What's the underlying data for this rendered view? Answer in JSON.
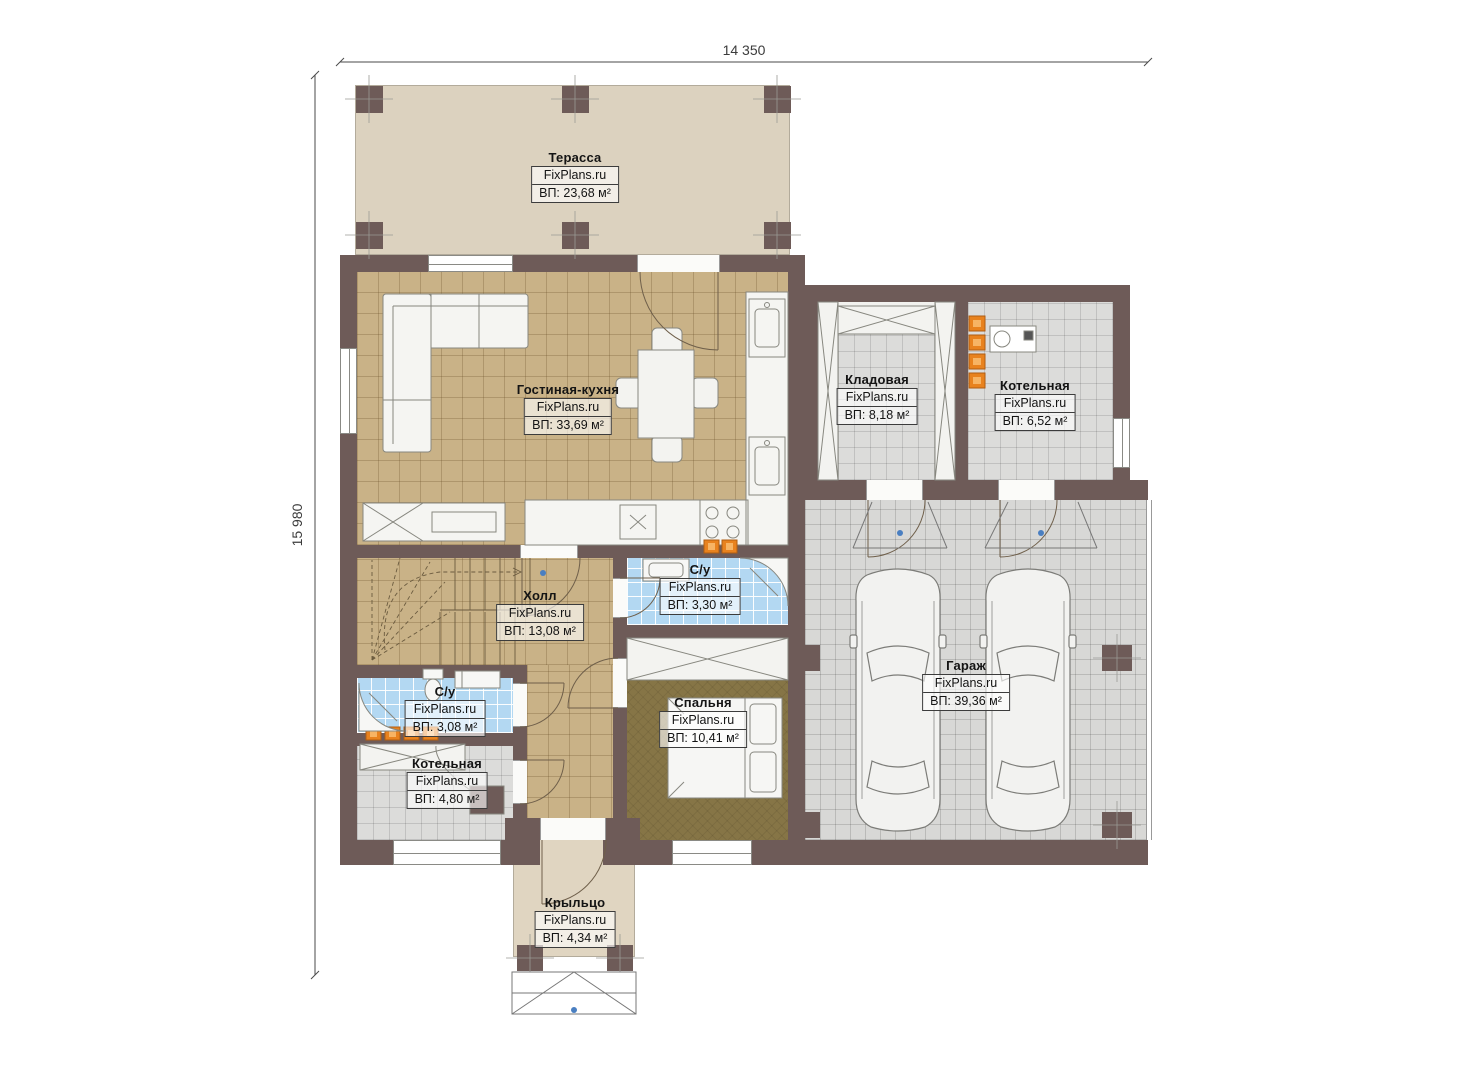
{
  "title": "Floor plan",
  "watermark": "FixPlans.ru",
  "dimensions": {
    "width_label": "14 350",
    "height_label": "15 980"
  },
  "rooms": [
    {
      "id": "terrace",
      "name": "Терасса",
      "area": "ВП: 23,68 м²"
    },
    {
      "id": "living_kitchen",
      "name": "Гостиная-кухня",
      "area": "ВП: 33,69 м²"
    },
    {
      "id": "storage",
      "name": "Кладовая",
      "area": "ВП: 8,18 м²"
    },
    {
      "id": "boiler_top",
      "name": "Котельная",
      "area": "ВП: 6,52 м²"
    },
    {
      "id": "hall",
      "name": "Холл",
      "area": "ВП: 13,08 м²"
    },
    {
      "id": "bath_small",
      "name": "С/у",
      "area": "ВП: 3,30 м²"
    },
    {
      "id": "bedroom",
      "name": "Спальня",
      "area": "ВП: 10,41 м²"
    },
    {
      "id": "bath_left",
      "name": "С/у",
      "area": "ВП: 3,08 м²"
    },
    {
      "id": "boiler_bottom",
      "name": "Котельная",
      "area": "ВП: 4,80 м²"
    },
    {
      "id": "garage",
      "name": "Гараж",
      "area": "ВП: 39,36 м²"
    },
    {
      "id": "porch",
      "name": "Крыльцо",
      "area": "ВП: 4,34 м²"
    }
  ],
  "colors": {
    "wall": "#6e5b58",
    "terrace_floor": "#dcd2bf",
    "wood_floor": "#c9b287",
    "bedroom_floor": "#867546",
    "bath_floor": "#b3d8f2",
    "tile_floor": "#dcdcda",
    "garage_floor": "#d8d8d6",
    "radiator": "#e8821e",
    "marker_blue": "#4a7fc1"
  }
}
